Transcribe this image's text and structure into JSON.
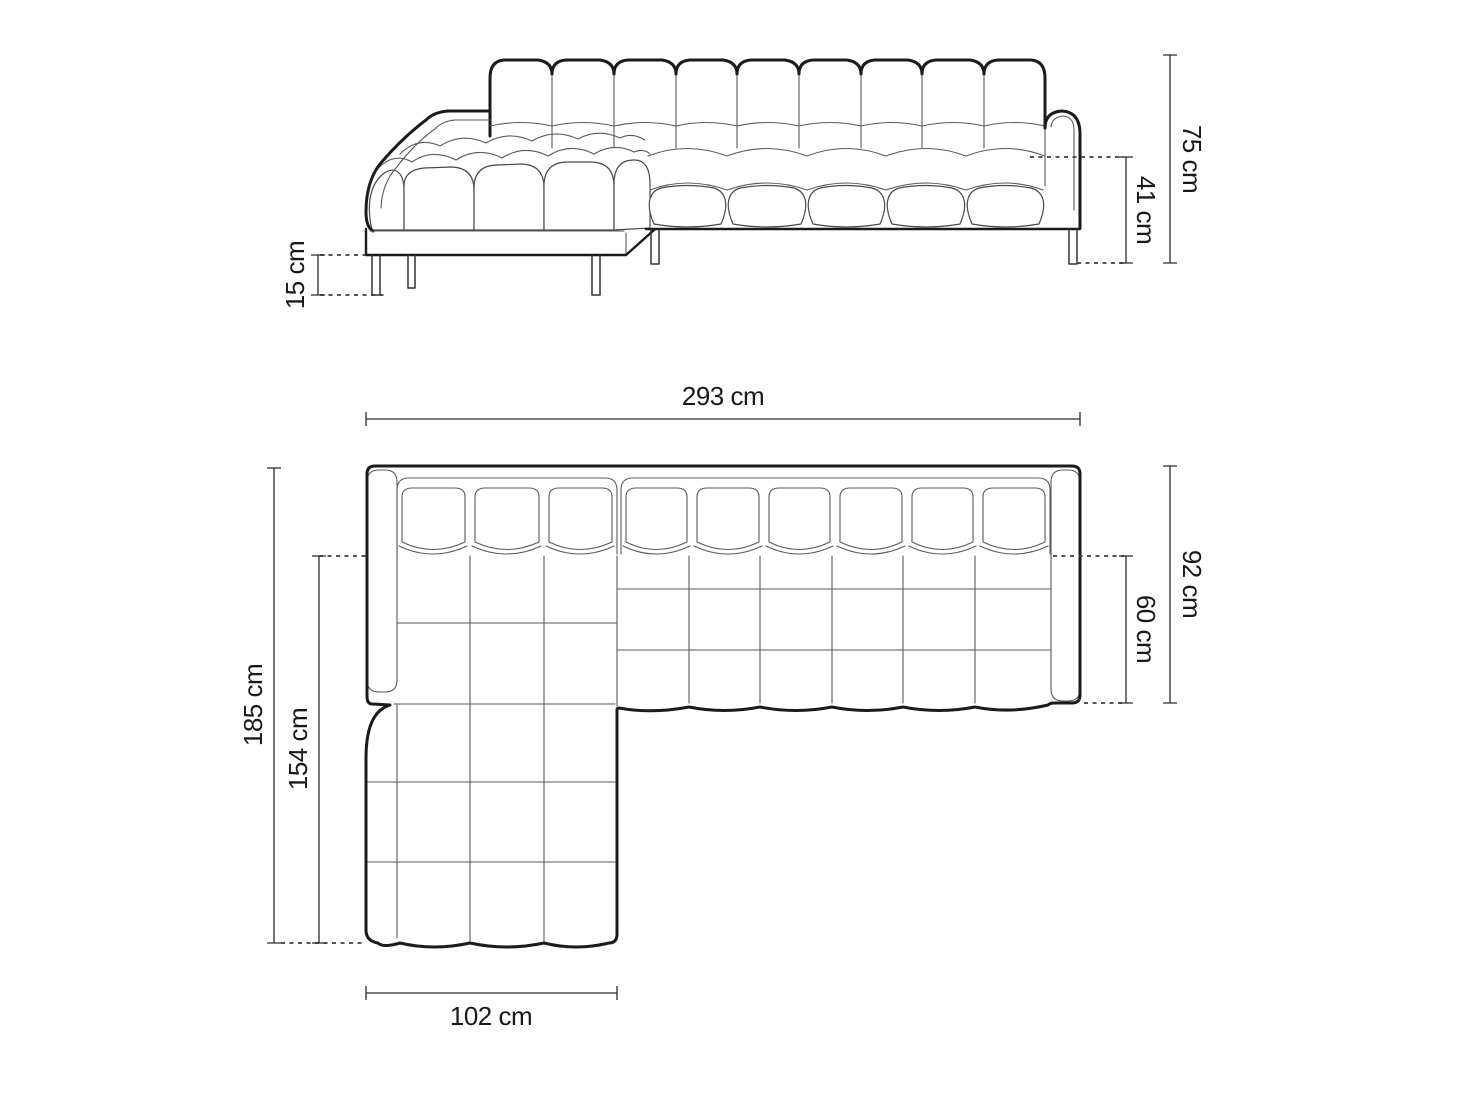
{
  "drawing": {
    "background": "#ffffff",
    "ink": "#1b1b1b",
    "front_view": {
      "dims": {
        "total_height": "75 cm",
        "seat_height": "41 cm",
        "leg_height": "15 cm"
      }
    },
    "plan_view": {
      "dims": {
        "total_width": "293 cm",
        "total_depth": "185 cm",
        "chaise_length": "154 cm",
        "side_depth": "92 cm",
        "seat_depth": "60 cm",
        "chaise_width": "102 cm"
      }
    }
  }
}
